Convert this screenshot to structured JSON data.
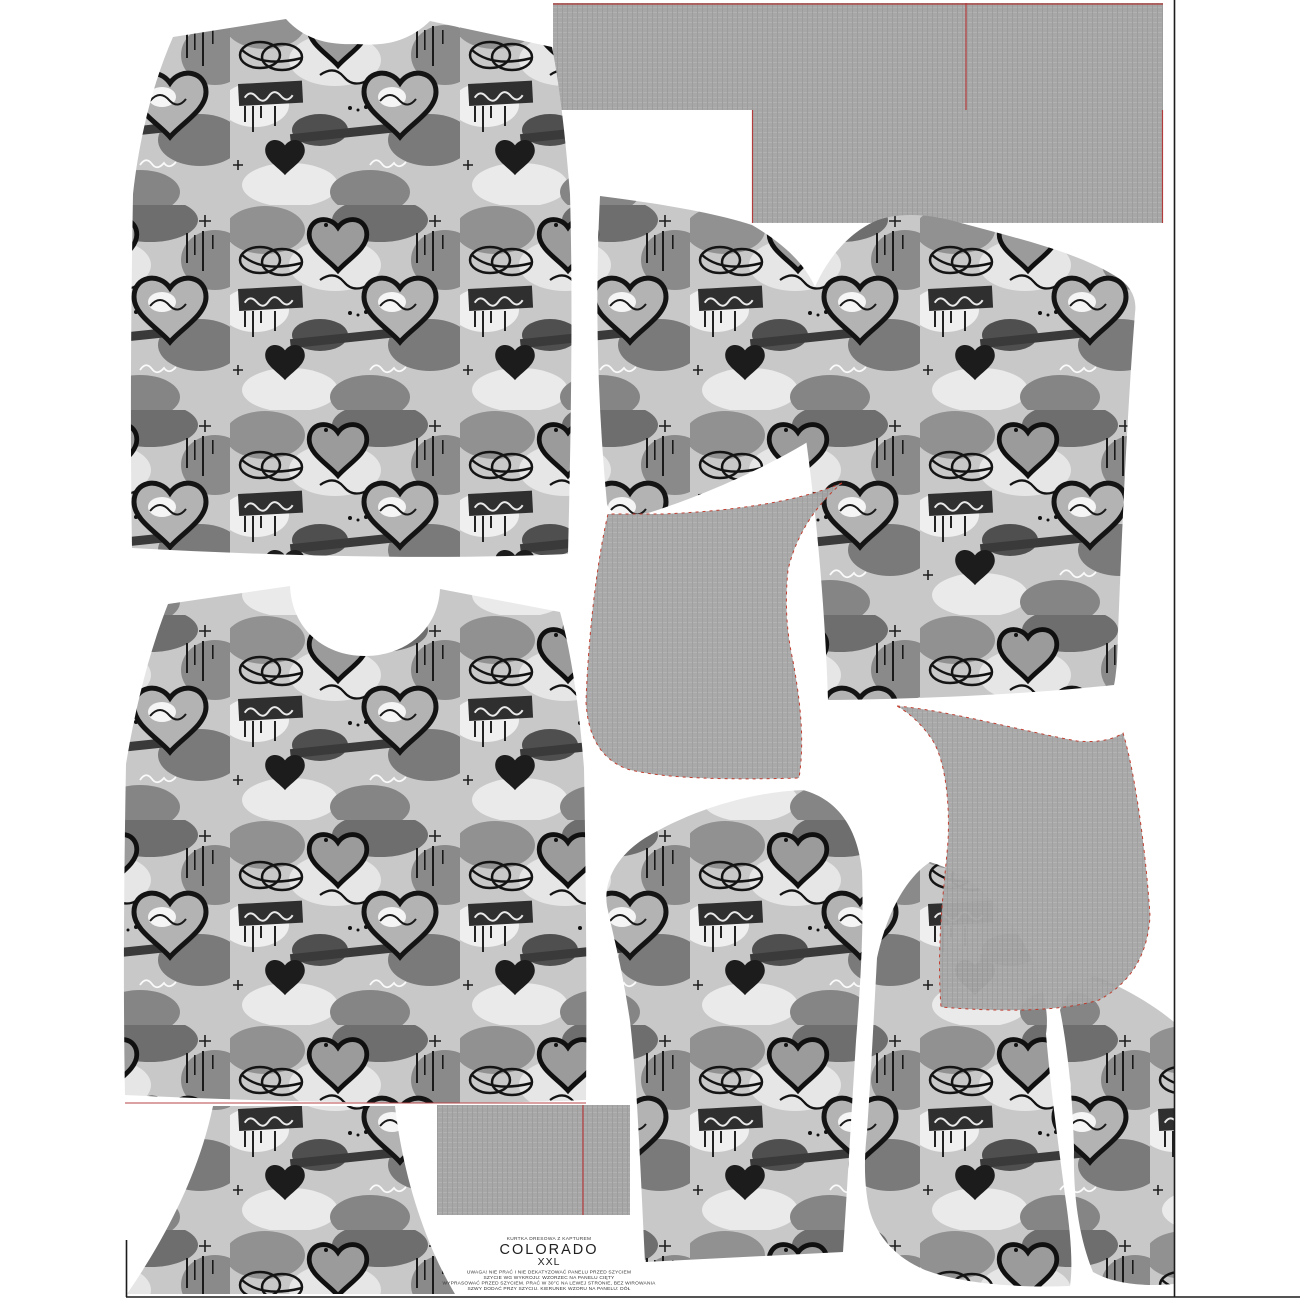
{
  "panel": {
    "product_line_label": "KURTKA DRESOWA Z KAPTUREM",
    "pattern_name": "COLORADO",
    "size_label": "XXL",
    "care_lines": [
      "UWAGA! NIE PRAĆ I NIE DEKATYZOWAĆ PANELU PRZED SZYCIEM",
      "SZYCIE WG WYKROJU: WZORZEC NA PANELU CIĘTY",
      "WYPRASOWAĆ PRZED SZYCIEM. PRAĆ W 30°C NA LEWEJ STRONIE, BEZ WIROWANIA",
      "SZWY DODAĆ PRZY SZYCIU. KIERUNEK WZORU NA PANELU: DÓŁ"
    ],
    "colors": {
      "background": "#ffffff",
      "print_base": "#c8c8c8",
      "print_ink": "#161616",
      "ribbing_gray": "#a7a7a7",
      "cut_mark_red": "#b23b3b",
      "boundary_black": "#1c1c1c"
    },
    "pieces": [
      {
        "id": "back-bodice",
        "fabric": "graffiti-print"
      },
      {
        "id": "front-bodice",
        "fabric": "graffiti-print"
      },
      {
        "id": "bodice-partial-bottom",
        "fabric": "graffiti-print"
      },
      {
        "id": "sleeve-upper-left",
        "fabric": "graffiti-print"
      },
      {
        "id": "sleeve-upper-right",
        "fabric": "graffiti-print"
      },
      {
        "id": "sleeve-lower-middle",
        "fabric": "graffiti-print"
      },
      {
        "id": "sleeve-lower-right",
        "fabric": "graffiti-print"
      },
      {
        "id": "edge-partial-right",
        "fabric": "graffiti-print"
      },
      {
        "id": "hood-left",
        "fabric": "plain-gray"
      },
      {
        "id": "hood-right",
        "fabric": "plain-gray"
      },
      {
        "id": "band-top-wide",
        "fabric": "plain-gray"
      },
      {
        "id": "band-top-lower",
        "fabric": "plain-gray"
      },
      {
        "id": "band-bottom",
        "fabric": "plain-gray"
      }
    ]
  }
}
